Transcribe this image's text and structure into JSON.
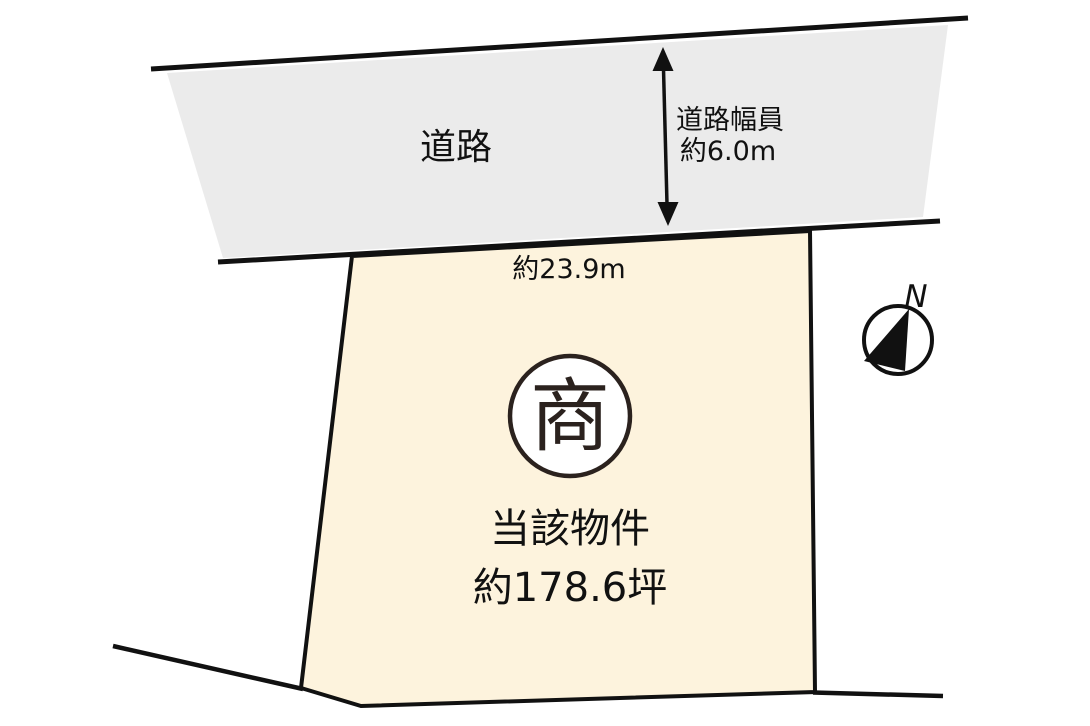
{
  "diagram": {
    "title": "lot-site-plan",
    "road": {
      "label": "道路"
    },
    "road_width": {
      "line1": "道路幅員",
      "line2": "約6.0m"
    },
    "frontage": {
      "label": "約23.9m"
    },
    "lot": {
      "zoning_mark": "商",
      "name": "当該物件",
      "area": "約178.6坪"
    },
    "compass": {
      "label": "N"
    },
    "colors": {
      "road_fill": "#ebebeb",
      "lot_fill": "#fdf3dd",
      "line": "#111111",
      "zoning_ink": "#2b221e",
      "background": "#ffffff"
    }
  }
}
